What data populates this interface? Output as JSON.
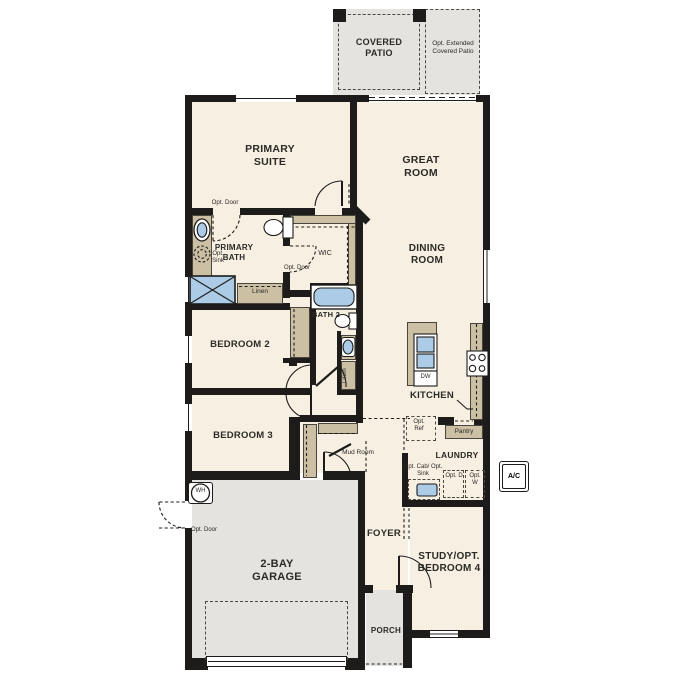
{
  "plan": {
    "outdoor": {
      "covered_patio": "COVERED PATIO",
      "extended_patio": "Opt. Extended Covered Patio",
      "porch": "PORCH",
      "ac": "A/C"
    },
    "rooms": {
      "primary_suite": "PRIMARY SUITE",
      "great_room": "GREAT ROOM",
      "dining_room": "DINING ROOM",
      "primary_bath": "PRIMARY BATH",
      "wic": "WIC",
      "bath_2": "BATH 2",
      "bedroom_2": "BEDROOM 2",
      "bedroom_3": "BEDROOM 3",
      "kitchen": "KITCHEN",
      "laundry": "LAUNDRY",
      "mud_room": "Mud Room",
      "foyer": "FOYER",
      "garage": "2-BAY GARAGE",
      "study": "STUDY/OPT. BEDROOM 4"
    },
    "annotations": {
      "opt_door": "Opt. Door",
      "opt_sink": "Opt. Sink",
      "linen": "Linen",
      "opt_ref": "Opt. Ref",
      "pantry": "Pantry",
      "opt_cab_opt_sink": "Opt. Cab/ Opt. Sink",
      "opt_dryer": "Opt. D",
      "opt_washer": "Opt. W",
      "water_heater": "WH",
      "dishwasher": "DW"
    },
    "colors": {
      "floor": "#f6efe2",
      "concrete": "#e4e3e0",
      "wall": "#1d1c1a",
      "cabinet": "#cbbfa4",
      "fixture": "#abcbe6",
      "dash": "#4a4840",
      "text": "#2b2a26"
    }
  }
}
